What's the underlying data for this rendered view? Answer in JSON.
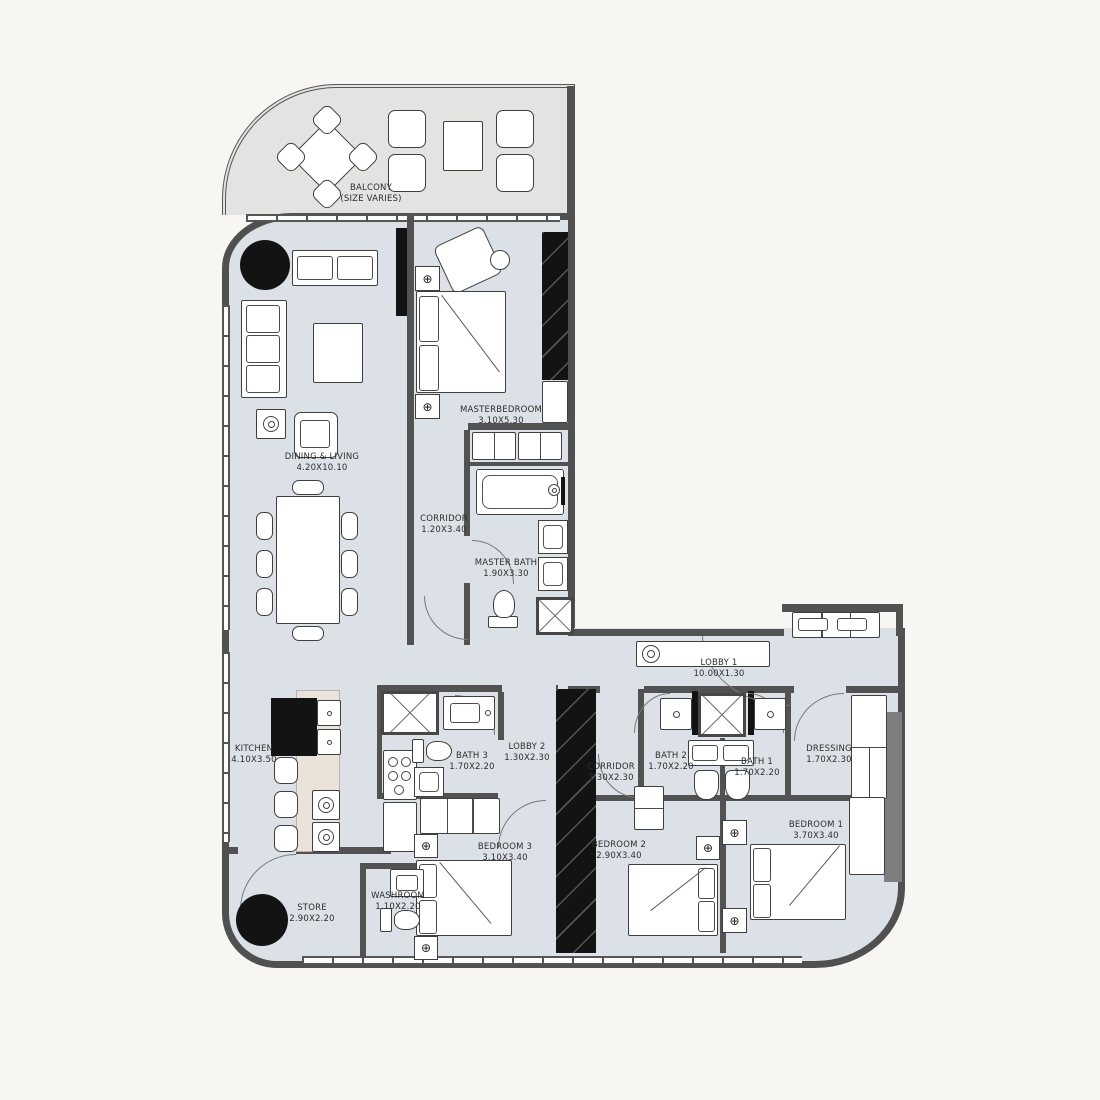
{
  "plan": {
    "title": "Residential Apartment Floor Plan",
    "colors": {
      "background": "#f7f6f3",
      "interior": "#dbe1e6",
      "balcony": "#e3e3e1",
      "wall": "#525252",
      "black_fixture": "#131313",
      "kitchen_counter": "#eae3d9"
    },
    "icons": {
      "lamp": "⊕"
    },
    "rooms": [
      {
        "name": "BALCONY",
        "dims": "(SIZE VARIES)"
      },
      {
        "name": "MASTERBEDROOM",
        "dims": "3.10X5.30"
      },
      {
        "name": "DINING & LIVING",
        "dims": "4.20X10.10"
      },
      {
        "name": "CORRIDOR",
        "dims": "1.20X3.40"
      },
      {
        "name": "MASTER BATH",
        "dims": "1.90X3.30"
      },
      {
        "name": "LOBBY 1",
        "dims": "10.00X1.30"
      },
      {
        "name": "KITCHEN",
        "dims": "4.10X3.50"
      },
      {
        "name": "BATH 3",
        "dims": "1.70X2.20"
      },
      {
        "name": "LOBBY 2",
        "dims": "1.30X2.30"
      },
      {
        "name": "CORRIDOR",
        "dims": "1.30X2.30"
      },
      {
        "name": "BATH 2",
        "dims": "1.70X2.20"
      },
      {
        "name": "BATH 1",
        "dims": "1.70X2.20"
      },
      {
        "name": "DRESSING",
        "dims": "1.70X2.30"
      },
      {
        "name": "BEDROOM 1",
        "dims": "3.70X3.40"
      },
      {
        "name": "BEDROOM 2",
        "dims": "2.90X3.40"
      },
      {
        "name": "BEDROOM 3",
        "dims": "3.10X3.40"
      },
      {
        "name": "STORE",
        "dims": "2.90X2.20"
      },
      {
        "name": "WASHROOM",
        "dims": "1.10X2.20"
      }
    ]
  }
}
